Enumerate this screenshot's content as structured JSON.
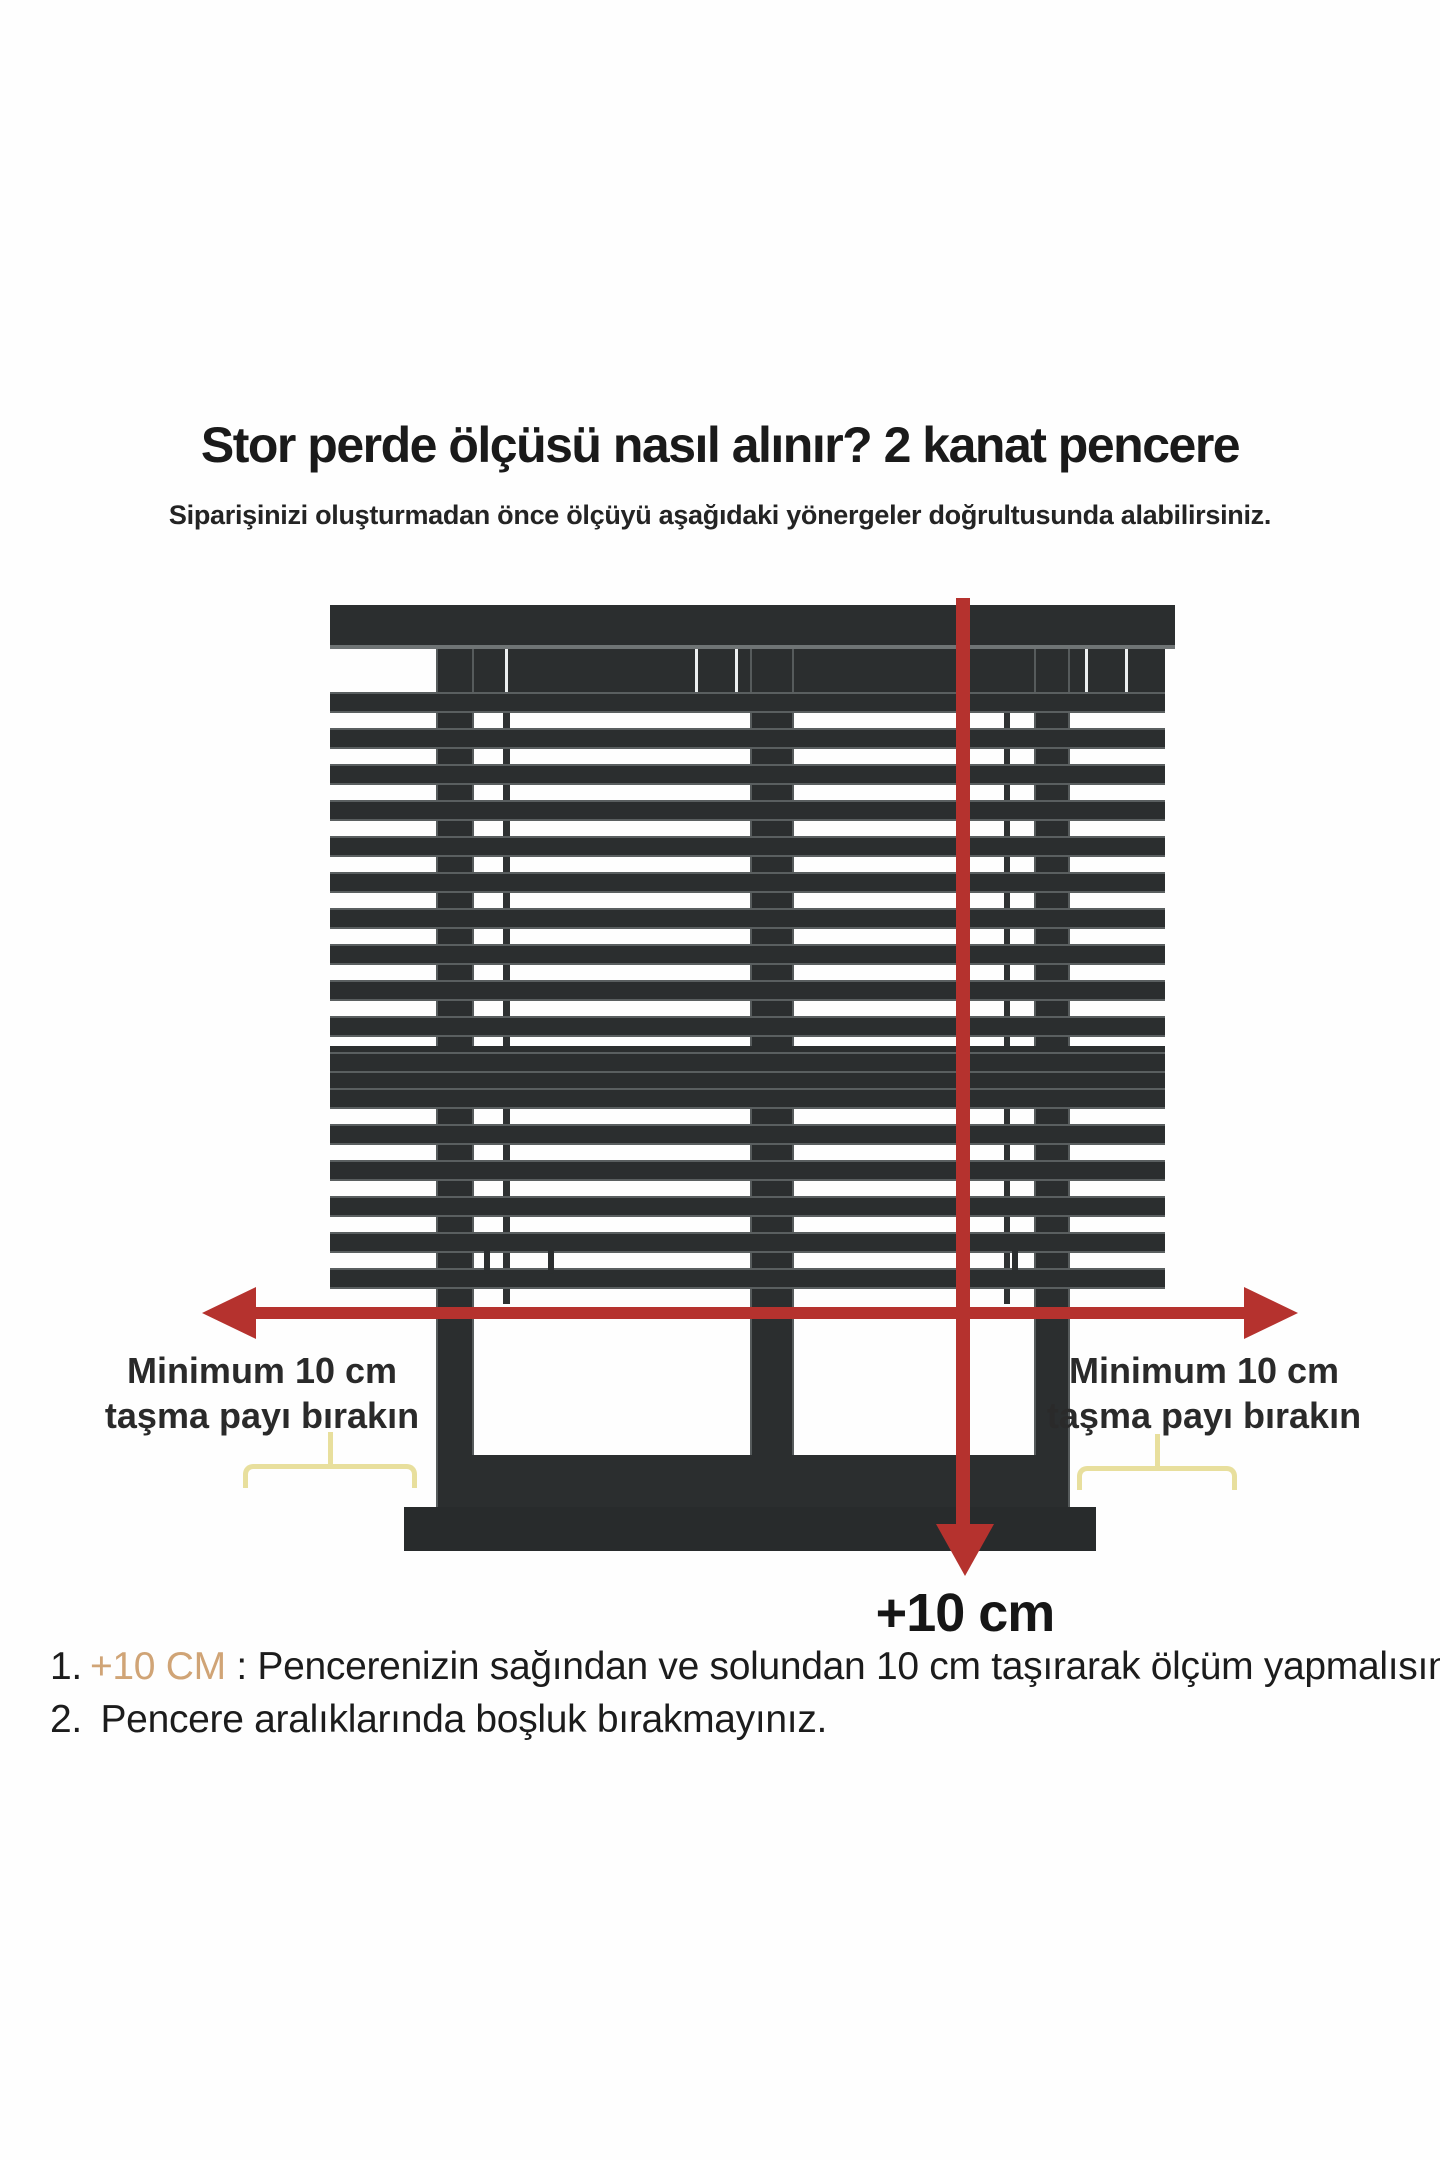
{
  "page": {
    "title": "Stor perde ölçüsü nasıl alınır? 2 kanat pencere",
    "subtitle": "Siparişinizi oluşturmadan önce ölçüyü aşağıdaki yönergeler doğrultusunda alabilirsiniz."
  },
  "diagram": {
    "left_label": {
      "line1": "Minimum 10 cm",
      "line2": "taşma payı bırakın"
    },
    "right_label": {
      "line1": "Minimum 10 cm",
      "line2": "taşma payı bırakın"
    },
    "bottom_measure_label": "+10 cm"
  },
  "instructions": {
    "item1": {
      "number": "1.",
      "highlight": "+10 CM",
      "text": " : Pencerenizin sağından ve solundan 10 cm taşırarak ölçüm yapmalısınız."
    },
    "item2": {
      "number": "2.",
      "text": " Pencere aralıklarında boşluk bırakmayınız."
    }
  },
  "colors": {
    "frame_dark": "#2b2e2f",
    "slat_edge": "#5a5f60",
    "arrow_red": "#b5322e",
    "brace_yellow": "#e8df9d",
    "highlight_tan": "#d0a476"
  }
}
